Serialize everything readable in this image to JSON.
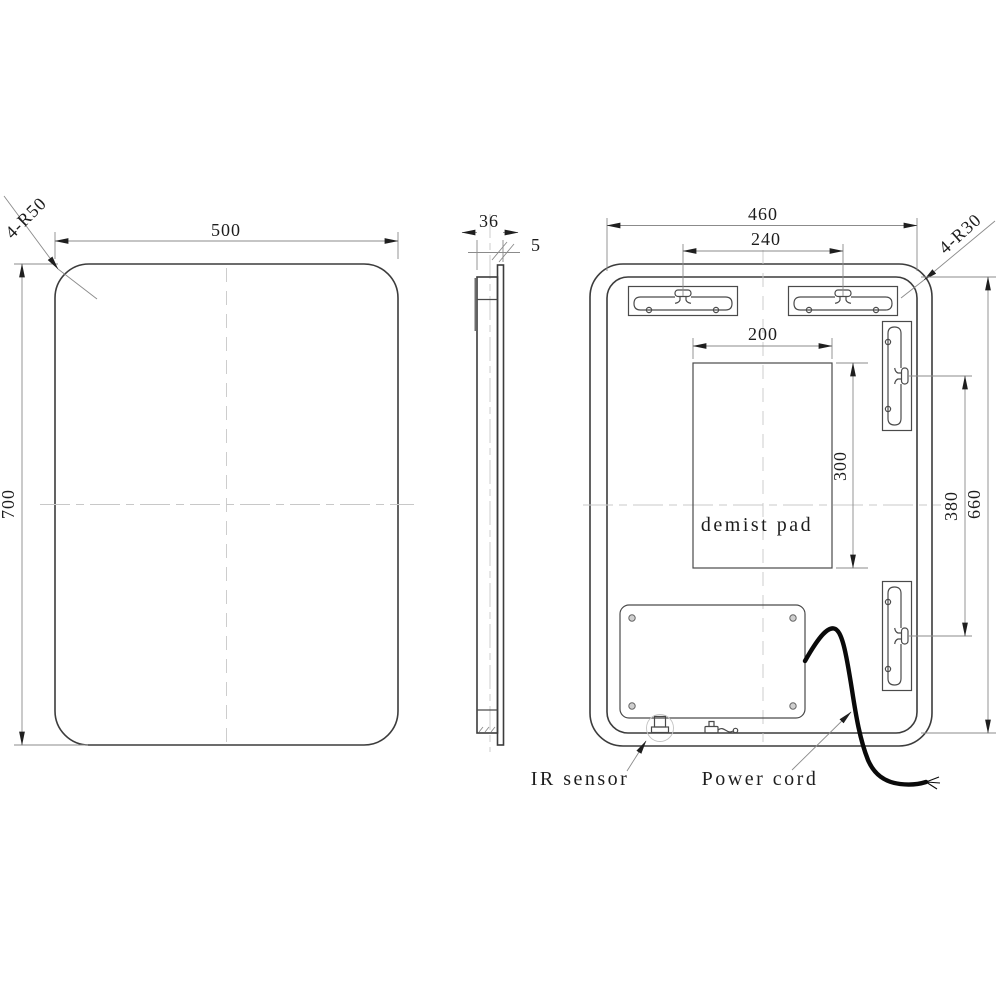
{
  "drawing": {
    "labels": {
      "front_width": "500",
      "front_height": "700",
      "front_corner_radius": "4-R50",
      "side_thickness": "36",
      "glass_thickness": "5",
      "back_width": "460",
      "back_height": "660",
      "back_corner_radius": "4-R30",
      "bracket_span": "240",
      "pad_width": "200",
      "pad_height": "300",
      "keyhole_span": "380",
      "demist_pad": "demist pad",
      "ir_sensor": "IR sensor",
      "power_cord": "Power cord"
    },
    "colors": {
      "object_line": "#3c3c3c",
      "dimension_line": "#8b8b8b",
      "centerline": "#c8c8c8",
      "text": "#1d1d1d",
      "power_cord": "#0a0a0a",
      "background": "#ffffff"
    }
  }
}
